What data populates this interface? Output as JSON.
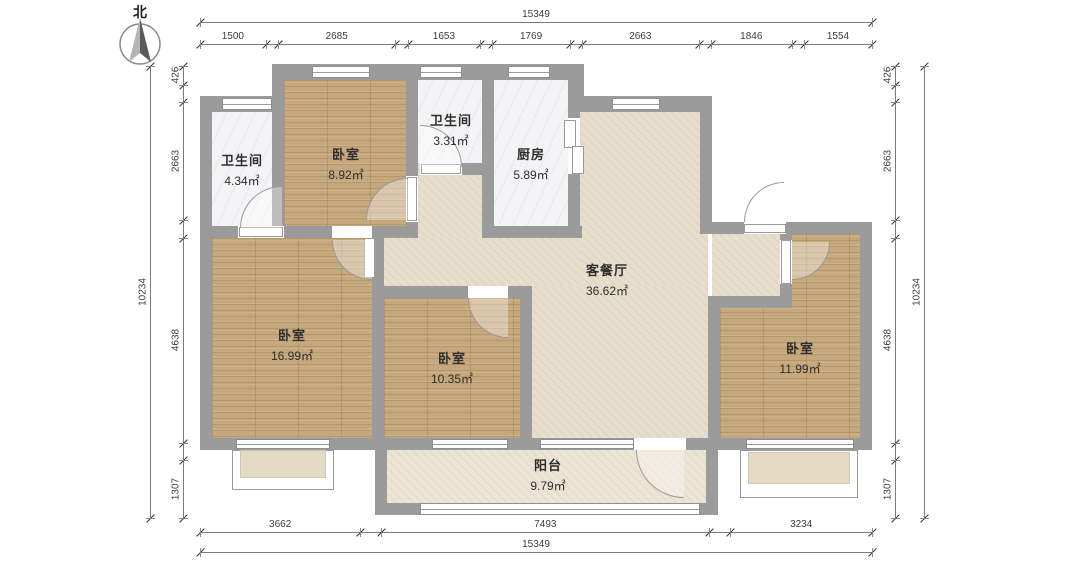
{
  "compass": {
    "label": "北"
  },
  "rooms": [
    {
      "id": "bath-nw",
      "name": "卫生间",
      "area": "4.34㎡"
    },
    {
      "id": "bed-n",
      "name": "卧室",
      "area": "8.92㎡"
    },
    {
      "id": "bath-n",
      "name": "卫生间",
      "area": "3.31㎡"
    },
    {
      "id": "kitchen",
      "name": "厨房",
      "area": "5.89㎡"
    },
    {
      "id": "living",
      "name": "客餐厅",
      "area": "36.62㎡"
    },
    {
      "id": "bed-w",
      "name": "卧室",
      "area": "16.99㎡"
    },
    {
      "id": "bed-s",
      "name": "卧室",
      "area": "10.35㎡"
    },
    {
      "id": "bed-e",
      "name": "卧室",
      "area": "11.99㎡"
    },
    {
      "id": "balcony",
      "name": "阳台",
      "area": "9.79㎡"
    }
  ],
  "dimensions": {
    "top": {
      "total": "15349",
      "segments": [
        "1500",
        "2685",
        "1653",
        "1769",
        "2663",
        "1846",
        "1554"
      ]
    },
    "bottom": {
      "total": "15349",
      "segments": [
        "3662",
        "7493",
        "3234"
      ]
    },
    "left": {
      "total": "10234",
      "segments": [
        "426",
        "2663",
        "4638",
        "1307"
      ]
    },
    "right": {
      "total": "10234",
      "segments": [
        "426",
        "2663",
        "4638",
        "1307"
      ]
    }
  },
  "colors": {
    "wall": "#9b9b9b",
    "wood_floor": "#c6a87d",
    "tile_floor": "#f4f4f6",
    "living_floor": "#e7dfce",
    "balcony_floor": "#ece4d4"
  }
}
